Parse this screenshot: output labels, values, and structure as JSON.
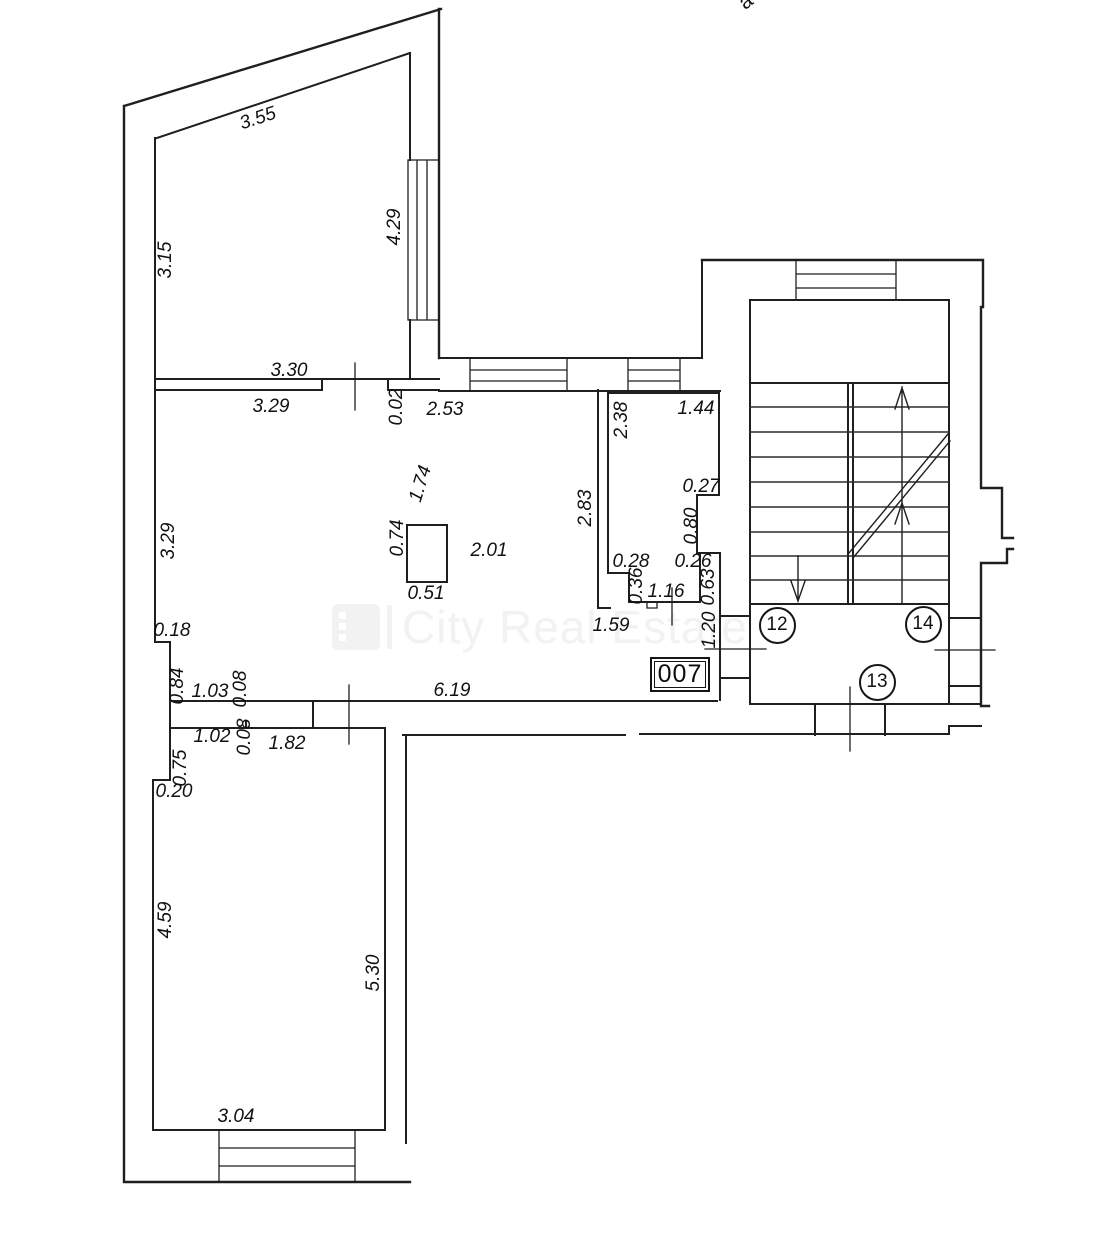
{
  "canvas": {
    "width": 1096,
    "height": 1244,
    "background": "#ffffff",
    "wall_color": "#1f1f1f"
  },
  "watermark": {
    "text": "City Real Estate",
    "color": "#f2f2f2",
    "logo": "city-real-estate-logo"
  },
  "edge_label_top_right": {
    "text": "a",
    "x": 746,
    "y": 2,
    "rot": -38
  },
  "room_number_box": {
    "text": "007",
    "x": 650,
    "y": 657,
    "w": 60,
    "h": 35
  },
  "stair_circles": [
    {
      "text": "12",
      "x": 777,
      "y": 625
    },
    {
      "text": "14",
      "x": 923,
      "y": 624
    },
    {
      "text": "13",
      "x": 877,
      "y": 682
    }
  ],
  "dimensions": [
    {
      "text": "3.55",
      "x": 258,
      "y": 119,
      "rot": -18
    },
    {
      "text": "3.15",
      "x": 166,
      "y": 260,
      "rot": -90
    },
    {
      "text": "4.29",
      "x": 395,
      "y": 227,
      "rot": -90
    },
    {
      "text": "3.30",
      "x": 289,
      "y": 371,
      "rot": 0
    },
    {
      "text": "3.29",
      "x": 271,
      "y": 407,
      "rot": 0
    },
    {
      "text": "0.02",
      "x": 397,
      "y": 407,
      "rot": -90
    },
    {
      "text": "2.53",
      "x": 445,
      "y": 410,
      "rot": 0
    },
    {
      "text": "2.38",
      "x": 622,
      "y": 420,
      "rot": -90
    },
    {
      "text": "1.44",
      "x": 696,
      "y": 409,
      "rot": 0
    },
    {
      "text": "1.74",
      "x": 421,
      "y": 484,
      "rot": -73
    },
    {
      "text": "0.27",
      "x": 701,
      "y": 487,
      "rot": 0
    },
    {
      "text": "2.83",
      "x": 586,
      "y": 508,
      "rot": -90
    },
    {
      "text": "0.80",
      "x": 692,
      "y": 526,
      "rot": -90
    },
    {
      "text": "0.74",
      "x": 398,
      "y": 538,
      "rot": -90
    },
    {
      "text": "2.01",
      "x": 489,
      "y": 551,
      "rot": 0
    },
    {
      "text": "0.51",
      "x": 426,
      "y": 594,
      "rot": 0
    },
    {
      "text": "0.28",
      "x": 631,
      "y": 562,
      "rot": 0
    },
    {
      "text": "0.26",
      "x": 693,
      "y": 562,
      "rot": 0
    },
    {
      "text": "0.36",
      "x": 637,
      "y": 586,
      "rot": -90
    },
    {
      "text": "0.63",
      "x": 709,
      "y": 587,
      "rot": -90
    },
    {
      "text": "1.16",
      "x": 666,
      "y": 592,
      "rot": 0
    },
    {
      "text": "3.29",
      "x": 169,
      "y": 541,
      "rot": -90
    },
    {
      "text": "0.18",
      "x": 172,
      "y": 631,
      "rot": 0
    },
    {
      "text": "1.59",
      "x": 611,
      "y": 626,
      "rot": 0
    },
    {
      "text": "1.20",
      "x": 710,
      "y": 630,
      "rot": -90
    },
    {
      "text": "0.84",
      "x": 178,
      "y": 686,
      "rot": -90
    },
    {
      "text": "1.03",
      "x": 210,
      "y": 692,
      "rot": 0
    },
    {
      "text": "0.08",
      "x": 241,
      "y": 689,
      "rot": -90
    },
    {
      "text": "6.19",
      "x": 452,
      "y": 691,
      "rot": 0
    },
    {
      "text": "1.02",
      "x": 212,
      "y": 737,
      "rot": 0
    },
    {
      "text": "0.08",
      "x": 245,
      "y": 737,
      "rot": -90
    },
    {
      "text": "1.82",
      "x": 287,
      "y": 744,
      "rot": 0
    },
    {
      "text": "0.75",
      "x": 181,
      "y": 768,
      "rot": -90
    },
    {
      "text": "0.20",
      "x": 174,
      "y": 792,
      "rot": 0
    },
    {
      "text": "4.59",
      "x": 166,
      "y": 920,
      "rot": -90
    },
    {
      "text": "5.30",
      "x": 374,
      "y": 973,
      "rot": -90
    },
    {
      "text": "3.04",
      "x": 236,
      "y": 1117,
      "rot": 0
    }
  ]
}
